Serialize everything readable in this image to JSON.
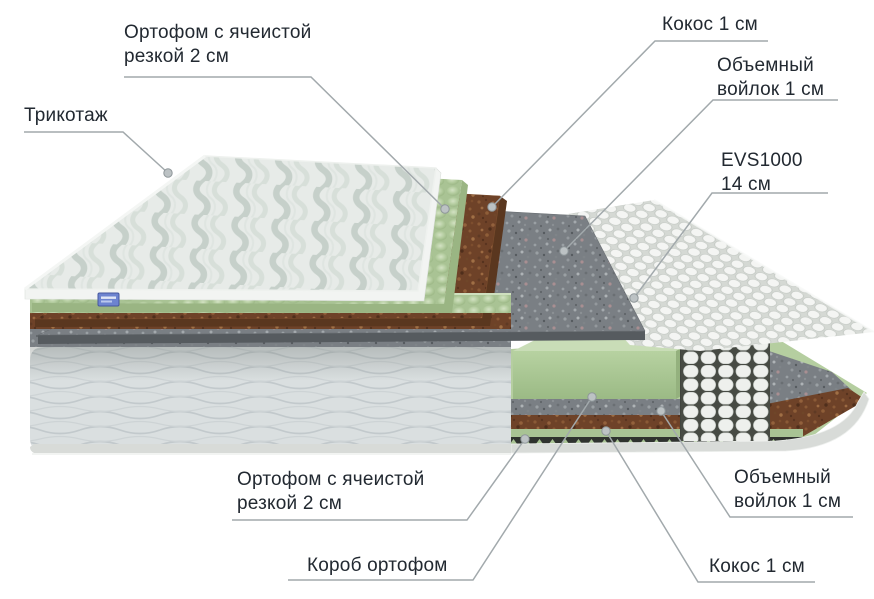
{
  "page": {
    "background": "#ffffff",
    "description_language": "ru"
  },
  "labels": {
    "trikotazh": {
      "text": "Трикотаж"
    },
    "ortofom_top": {
      "line1": "Ортофом с ячеистой",
      "line2": "резкой 2 см"
    },
    "kokos_top": {
      "text": "Кокос 1 см"
    },
    "voilok_top": {
      "line1": "Объемный",
      "line2": "войлок 1 см"
    },
    "evs": {
      "line1": "EVS1000",
      "line2": "14 см"
    },
    "ortofom_bottom": {
      "line1": "Ортофом с ячеистой",
      "line2": "резкой 2 см"
    },
    "korob": {
      "text": "Короб ортофом"
    },
    "voilok_bottom": {
      "line1": "Объемный",
      "line2": "войлок 1 см"
    },
    "kokos_bottom": {
      "text": "Кокос 1 см"
    }
  },
  "layers": [
    {
      "label": "Трикотаж",
      "color": "#e7ebe8"
    },
    {
      "label": "Ортофом с ячеистой резкой 2 см",
      "color": "#b2cb9d"
    },
    {
      "label": "Кокос 1 см",
      "color": "#6e4228"
    },
    {
      "label": "Объемный войлок 1 см",
      "color": "#7a7f84"
    },
    {
      "label": "EVS1000 14 см",
      "color": "#f3f4f2"
    },
    {
      "label": "Короб ортофом",
      "color": "#b5cea0"
    }
  ],
  "style": {
    "leader_line_color": "#a2a9ac",
    "text_color": "#222931",
    "tag_color": "#6d84d0"
  }
}
